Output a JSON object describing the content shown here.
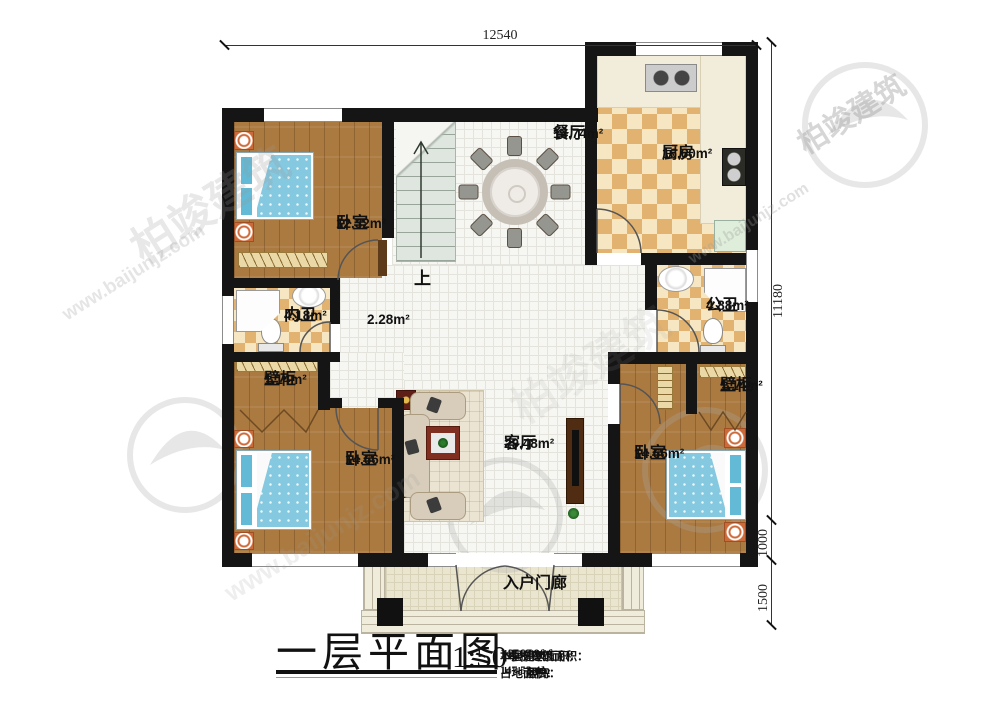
{
  "watermark": {
    "brand": "柏竣建筑",
    "url": "www.baijunjz.com"
  },
  "dimensions": {
    "top_width": "12540",
    "right_height": "11180",
    "porch_depth": "1000",
    "steps_depth": "1500"
  },
  "rooms": {
    "bedroom_tl": {
      "name": "卧室",
      "area": "12.32m²"
    },
    "dining": {
      "name": "餐厅",
      "area": "14.74m²"
    },
    "kitchen": {
      "name": "厨房",
      "area": "16.60m²"
    },
    "bath_inner": {
      "name": "内卫",
      "area": "4.18m²"
    },
    "hall": {
      "name": "",
      "area": "2.28m²"
    },
    "bath_public": {
      "name": "公卫",
      "area": "4.88m²"
    },
    "closet_left": {
      "name": "壁柜",
      "area": "1.14m²"
    },
    "closet_right": {
      "name": "壁柜",
      "area": "1.14m²"
    },
    "bedroom_bl": {
      "name": "卧室",
      "area": "14.66m²"
    },
    "living": {
      "name": "客厅",
      "area": "29.48m²"
    },
    "bedroom_br": {
      "name": "卧室",
      "area": "14.66m²"
    },
    "porch": {
      "name": "入户门廊"
    },
    "stairs": {
      "label": "上"
    }
  },
  "titleblock": {
    "title": "一层平面图",
    "scale": "1:50",
    "stats": [
      {
        "label": "本层建筑面积：",
        "value": "142.07m²"
      },
      {
        "label": "本栋建筑面积：",
        "value": "256.09m²"
      },
      {
        "label": "占地面积：",
        "value": "147.52m²"
      },
      {
        "label": "层高：",
        "value": "3.4m"
      }
    ]
  }
}
